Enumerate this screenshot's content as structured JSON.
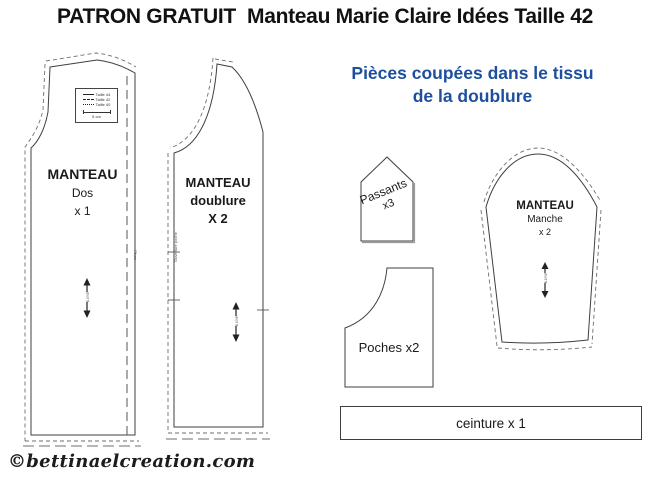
{
  "title": "PATRON GRATUIT  Manteau Marie Claire Idées Taille 42",
  "heading": {
    "line1": "Pièces coupées dans le tissu",
    "line2": "de la doublure",
    "color": "#1d4f9e"
  },
  "legend": {
    "rows": [
      {
        "style": "solid",
        "label": "Taille 44"
      },
      {
        "style": "dashdot",
        "label": "Taille 42"
      },
      {
        "style": "dashed",
        "label": "Taille 40"
      }
    ],
    "scale_label": "5 cm"
  },
  "pieces": {
    "dos": {
      "title": "MANTEAU",
      "subtitle": "Dos",
      "quantity": "x 1",
      "fold_label": "Pliure",
      "grain_label": "droit fil"
    },
    "doublure": {
      "title": "MANTEAU",
      "subtitle": "doublure",
      "quantity": "X 2",
      "notch_label": "Ouverture poche",
      "grain_label": "droit fil"
    },
    "manche": {
      "title": "MANTEAU",
      "subtitle": "Manche",
      "quantity": "x 2",
      "grain_label": "droit fil"
    },
    "passants": {
      "label": "Passants",
      "quantity": "x3"
    },
    "poches": {
      "label": "Poches x2"
    },
    "ceinture": {
      "label": "ceinture x 1"
    }
  },
  "watermark": "©bettinaelcreation.com"
}
